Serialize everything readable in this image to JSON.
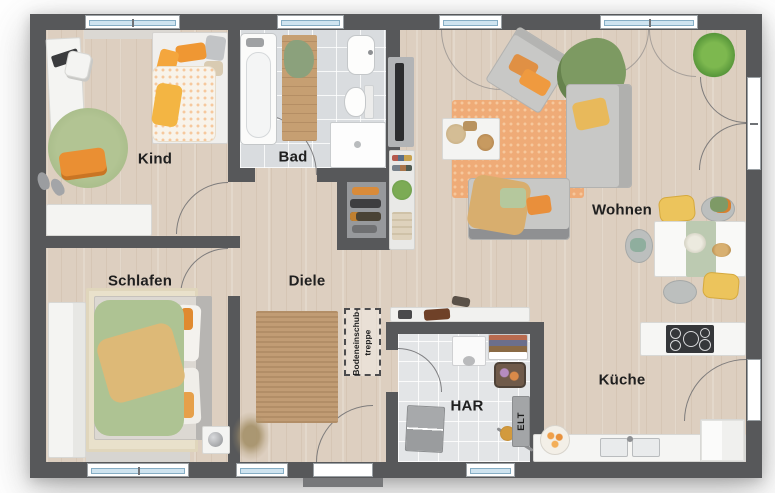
{
  "title": "Grundriss Erdgeschoss",
  "labels": {
    "kind": "Kind",
    "bad": "Bad",
    "wohnen": "Wohnen",
    "schlafen": "Schlafen",
    "diele": "Diele",
    "har": "HAR",
    "kueche": "Küche",
    "elt": "ELT",
    "attic_line1": "Bodeneinschub-",
    "attic_line2": "treppe"
  },
  "rooms": [
    {
      "name": "Kind"
    },
    {
      "name": "Bad"
    },
    {
      "name": "Wohnen"
    },
    {
      "name": "Schlafen"
    },
    {
      "name": "Diele"
    },
    {
      "name": "HAR"
    },
    {
      "name": "Küche"
    }
  ],
  "annotations": {
    "attic_stairs": "Bodeneinschub-treppe",
    "electrical_cabinet": "ELT"
  },
  "colors": {
    "wall": "#57585a",
    "floor-wood": "#ddcfc0",
    "floor-tile-bad": "#d9dcdf",
    "floor-tile-har": "#e3e5e7",
    "window-glass": "#cfe4f0",
    "label-text": "#1f1f1f",
    "accent-orange": "#e8913c",
    "accent-green": "#a9bc8d",
    "accent-yellow": "#e9bd58",
    "rug-jute": "#c19c74"
  }
}
